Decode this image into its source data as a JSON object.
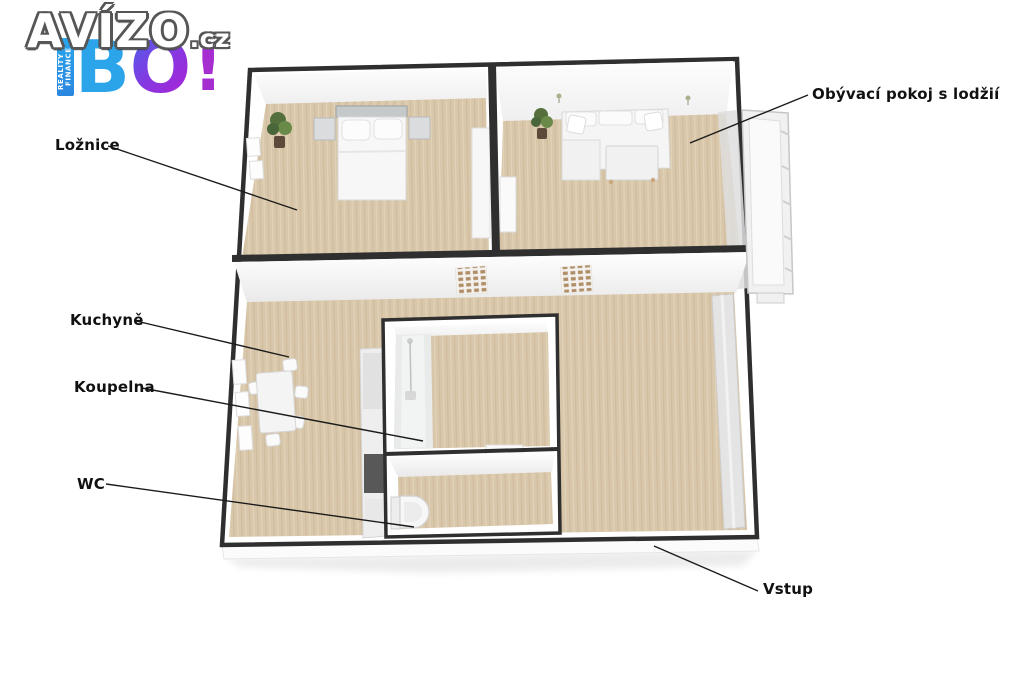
{
  "watermark": {
    "brand": "AVÍZO",
    "suffix": ".cz",
    "tagline": "REALITY & FINANCE",
    "letters": {
      "b": "B",
      "o": "O",
      "bang": "!"
    },
    "colors": {
      "blue": "#2ba4ea",
      "purple": "#8a35e0",
      "magenta": "#a62ed1"
    }
  },
  "annotations": {
    "loznice": "Ložnice",
    "obyvaci": "Obývací pokoj s lodžií",
    "kuchyne": "Kuchyně",
    "koupelna": "Koupelna",
    "wc": "WC",
    "vstup": "Vstup"
  },
  "plan_colors": {
    "floor": "#d9c7ab",
    "wall_outline": "#2f2f2f",
    "wall_face": "#ffffff",
    "label_text": "#111111"
  }
}
